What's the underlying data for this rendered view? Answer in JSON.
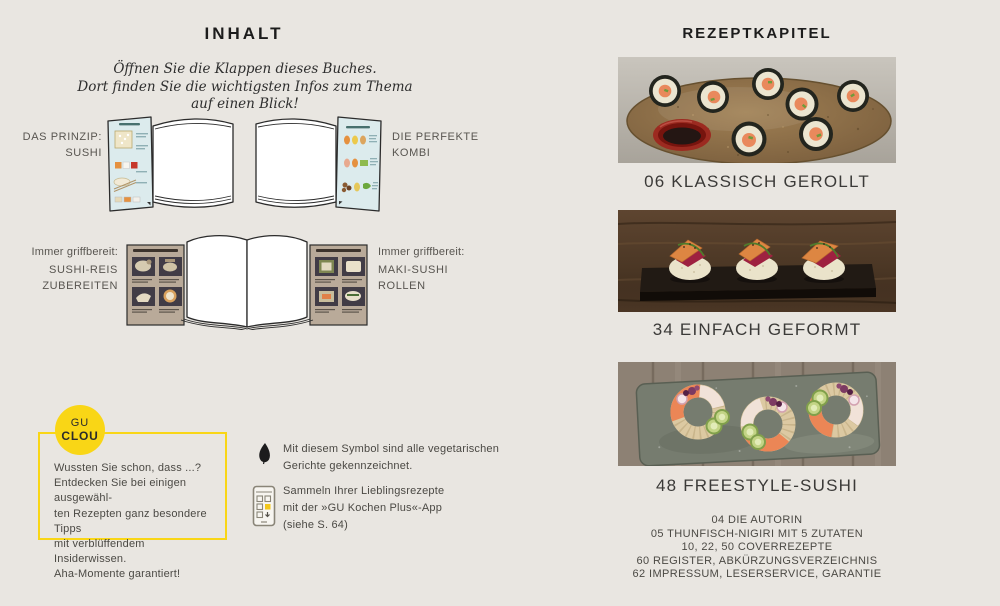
{
  "colors": {
    "background": "#e9e6e1",
    "accent_yellow": "#f9d616",
    "text_dark": "#1c1c1c",
    "text_medium": "#4b4944"
  },
  "left_page": {
    "title": "INHALT",
    "intro": {
      "line1": "Öffnen Sie die Klappen dieses Buches.",
      "line2": "Dort finden Sie die wichtigsten Infos zum Thema auf einen Blick!"
    },
    "row1": {
      "left_label": {
        "line1": "DAS PRINZIP:",
        "line2": "SUSHI"
      },
      "right_label": {
        "line1": "DIE PERFEKTE",
        "line2": "KOMBI"
      }
    },
    "row2": {
      "left_label": {
        "line1": "Immer griffbereit:",
        "line2": "SUSHI-REIS",
        "line3": "ZUBEREITEN"
      },
      "right_label": {
        "line1": "Immer griffbereit:",
        "line2": "MAKI-SUSHI",
        "line3": "ROLLEN"
      }
    },
    "clou_box": {
      "badge_top": "GU",
      "badge_bottom": "CLOU",
      "lines": [
        "Wussten Sie schon, dass ...?",
        "Entdecken Sie bei einigen ausgewähl-",
        "ten Rezepten ganz besondere Tipps",
        "mit verblüffendem Insiderwissen.",
        "Aha-Momente garantiert!"
      ]
    },
    "veg_note": {
      "icon": "leaf-icon",
      "line1": "Mit diesem Symbol sind alle vegetarischen",
      "line2": "Gerichte gekennzeichnet."
    },
    "app_note": {
      "icon": "smartphone-app-icon",
      "line1": "Sammeln Ihrer Lieblingsrezepte",
      "line2": "mit der »GU Kochen Plus«-App",
      "line3": "(siehe S. 64)"
    }
  },
  "right_page": {
    "title": "REZEPTKAPITEL",
    "chapters": [
      {
        "caption": "06 KLASSISCH GEROLLT",
        "photo": "maki-rolls-on-ceramic-plate"
      },
      {
        "caption": "34 EINFACH GEFORMT",
        "photo": "vegetable-nigiri-on-slate-board"
      },
      {
        "caption": "48 FREESTYLE-SUSHI",
        "photo": "sushi-donuts-on-stone-platter"
      }
    ],
    "index_lines": [
      "04 DIE AUTORIN",
      "05 THUNFISCH-NIGIRI MIT 5 ZUTATEN",
      "10, 22, 50 COVERREZEPTE",
      "60 REGISTER, ABKÜRZUNGSVERZEICHNIS",
      "62 IMPRESSUM, LESERSERVICE, GARANTIE"
    ]
  }
}
